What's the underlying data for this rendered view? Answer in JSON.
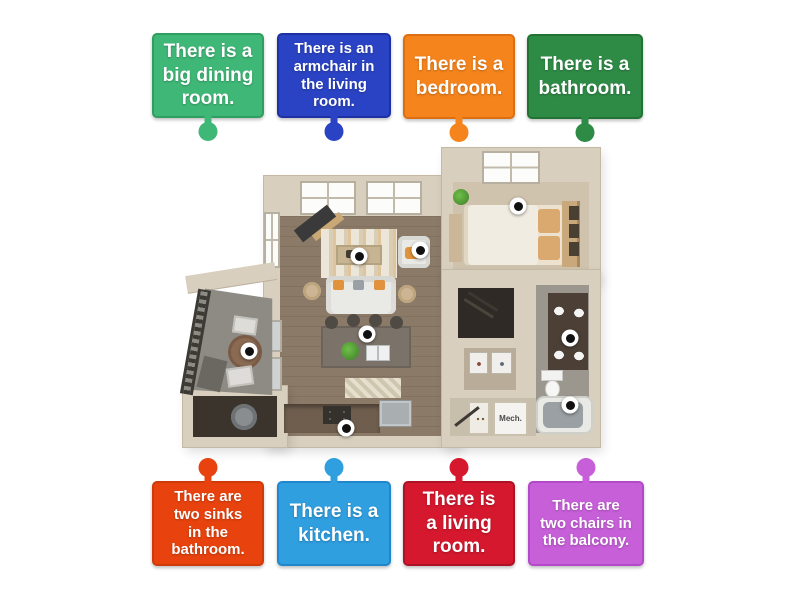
{
  "cards": [
    {
      "id": "big-dining-room",
      "text": "There is a big dining room.",
      "color": "#3fb877",
      "border": "#2f9e61",
      "row": "top"
    },
    {
      "id": "armchair-living-room",
      "text": "There is an armchair in the living room.",
      "color": "#2a43c4",
      "border": "#1d31a5",
      "row": "top"
    },
    {
      "id": "bedroom",
      "text": "There is a bedroom.",
      "color": "#f5841d",
      "border": "#de6f10",
      "row": "top"
    },
    {
      "id": "bathroom",
      "text": "There is a bathroom.",
      "color": "#2e8b46",
      "border": "#217334",
      "row": "top"
    },
    {
      "id": "two-sinks-bathroom",
      "text": "There are two sinks in the bathroom.",
      "color": "#e8430e",
      "border": "#cf3a09",
      "row": "bottom"
    },
    {
      "id": "kitchen",
      "text": "There is a kitchen.",
      "color": "#2f9fe0",
      "border": "#2187cc",
      "row": "bottom"
    },
    {
      "id": "living-room",
      "text": "There is a living room.",
      "color": "#d5182e",
      "border": "#ad1326",
      "row": "bottom"
    },
    {
      "id": "two-chairs-balcony",
      "text": "There are two chairs in the balcony.",
      "color": "#c75fd9",
      "border": "#b348c9",
      "row": "bottom"
    }
  ],
  "pins": [
    {
      "name": "coffee-table",
      "x": 359,
      "y": 256
    },
    {
      "name": "armchair",
      "x": 420,
      "y": 250
    },
    {
      "name": "bed",
      "x": 518,
      "y": 206
    },
    {
      "name": "balcony-table",
      "x": 249,
      "y": 351
    },
    {
      "name": "kitchen-island",
      "x": 367,
      "y": 334
    },
    {
      "name": "bathroom-vanity",
      "x": 570,
      "y": 338
    },
    {
      "name": "bathtub",
      "x": 570,
      "y": 405
    },
    {
      "name": "kitchen-counter",
      "x": 346,
      "y": 428
    }
  ],
  "floorplan": {
    "mech_label": "Mech."
  }
}
